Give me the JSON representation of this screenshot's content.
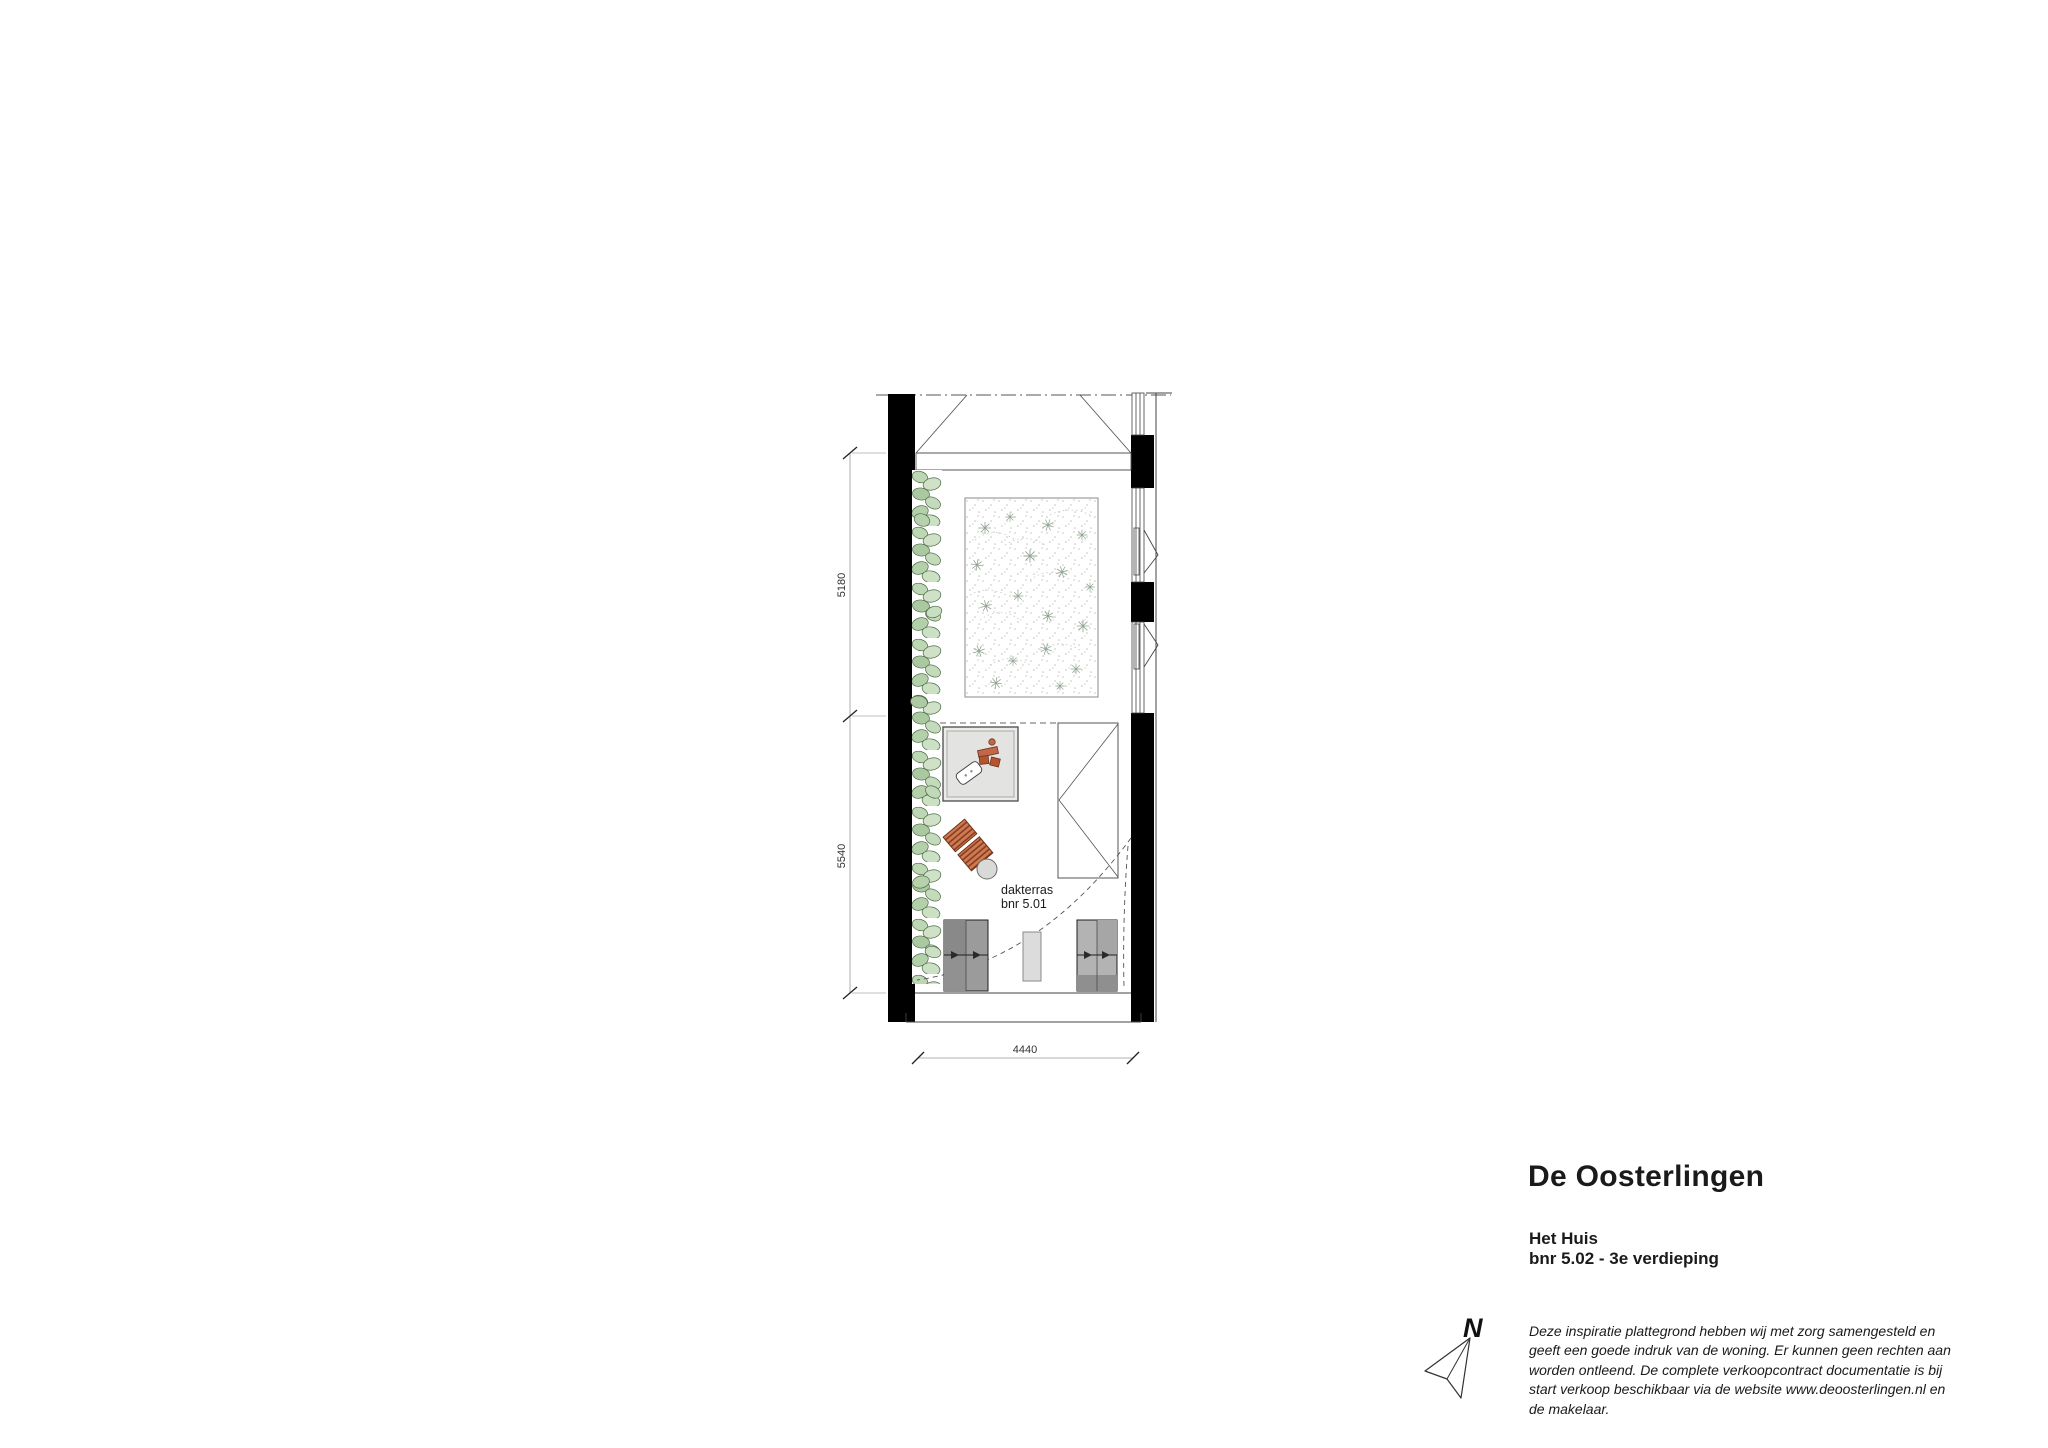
{
  "document": {
    "project_title": "De Oosterlingen",
    "building": "Het Huis",
    "unit": "bnr 5.02 - 3e verdieping",
    "north_label": "N",
    "disclaimer_lines": [
      "Deze inspiratie plattegrond hebben wij met zorg samengesteld en",
      "geeft een goede indruk van de woning. Er kunnen geen rechten aan",
      "worden ontleend. De complete verkoopcontract documentatie is bij",
      "start verkoop beschikbaar via de website www.deoosterlingen.nl en",
      "de makelaar."
    ]
  },
  "plan": {
    "area_label_line1": "dakterras",
    "area_label_line2": "bnr 5.01",
    "dim_left_upper": "5180",
    "dim_left_lower": "5540",
    "dim_bottom": "4440",
    "colors": {
      "wall": "#000000",
      "line": "#555555",
      "hedge_green": "#b9d3af",
      "terracotta": "#bf5f3a",
      "furniture_gray": "#9b9b9b"
    }
  }
}
